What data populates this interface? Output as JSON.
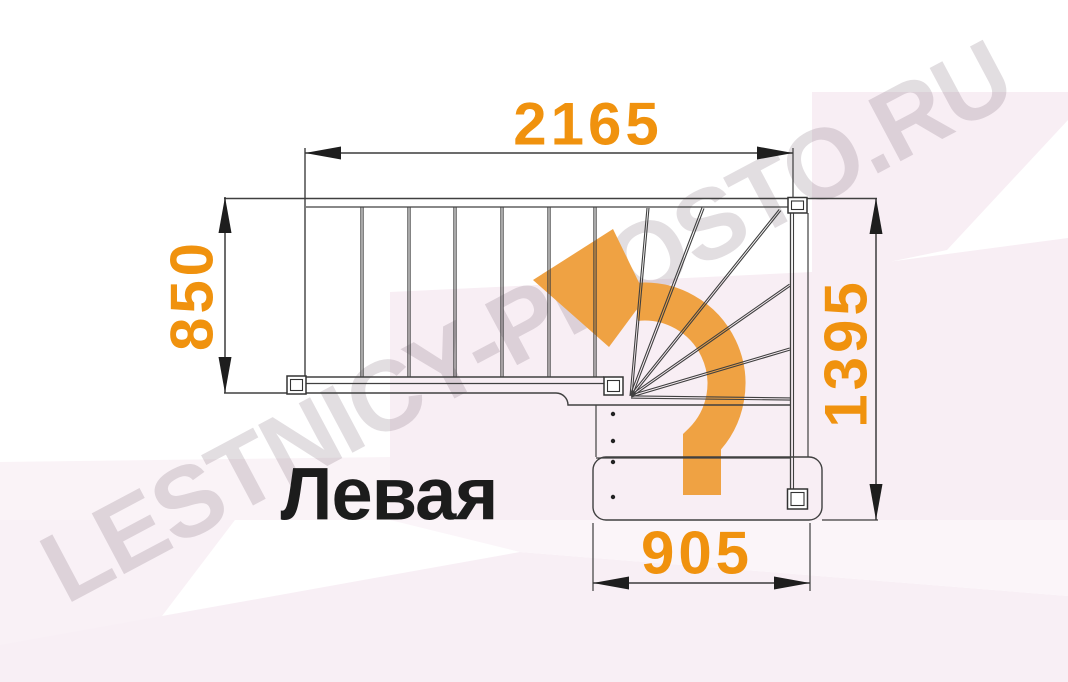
{
  "watermark": {
    "text": "LESTNICY-PROSTO.RU"
  },
  "plan": {
    "title": "Левая",
    "dimensions": {
      "top": "2165",
      "left": "850",
      "right": "1395",
      "bottom": "905"
    },
    "stairs": {
      "straight_treads": 6,
      "winder_treads": 6,
      "bottom_flight_treads": 3,
      "turn_direction": "left"
    },
    "colors": {
      "dimension_text": "#f0920e",
      "direction_arrow": "#efa243",
      "drawing_line": "#404040",
      "accent_background": "#f8eef4",
      "title_text": "#1c1c1c",
      "watermark_text": "#e2dee1"
    }
  }
}
